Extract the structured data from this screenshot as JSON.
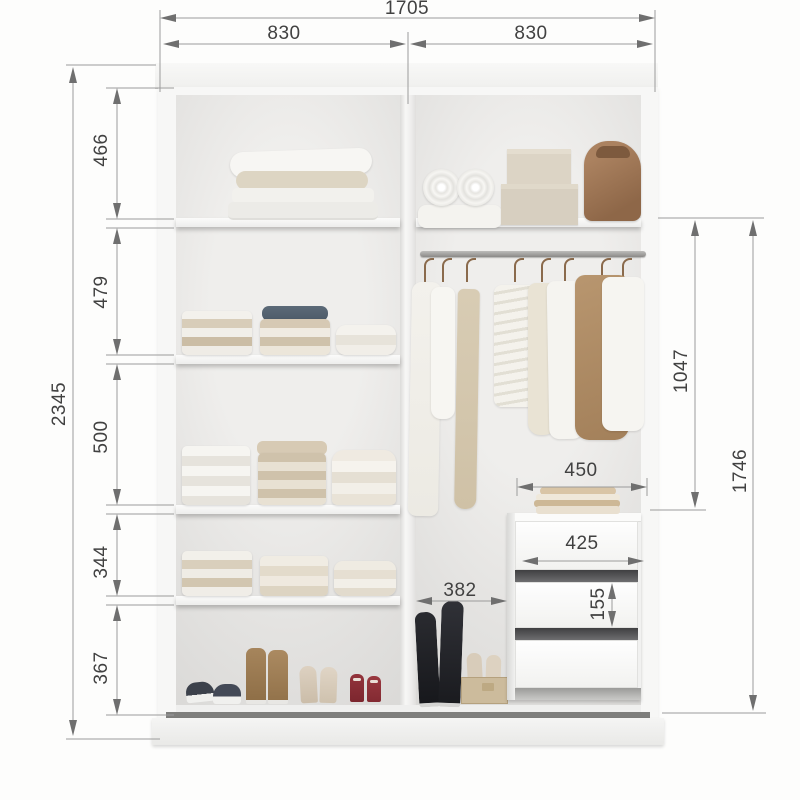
{
  "dims": {
    "total_width": "1705",
    "left_section_width": "830",
    "right_section_width": "830",
    "total_height": "2345",
    "left_compartments": [
      "466",
      "479",
      "500",
      "344",
      "367"
    ],
    "hanging_zone_height": "1047",
    "right_section_height": "1746",
    "shelf_over_drawers_width": "450",
    "drawer_width": "425",
    "drawer_height": "155",
    "floor_bay_width": "382"
  },
  "colors": {
    "dimension_line": "#9b9b9b",
    "dimension_arrow": "#6f6f6f",
    "dimension_text": "#414141",
    "carcass_white": "#f6f6f5",
    "interior_back": "#e4e3e1",
    "track_dark": "#8d8d8d",
    "wood_accent": "#a3805a"
  }
}
